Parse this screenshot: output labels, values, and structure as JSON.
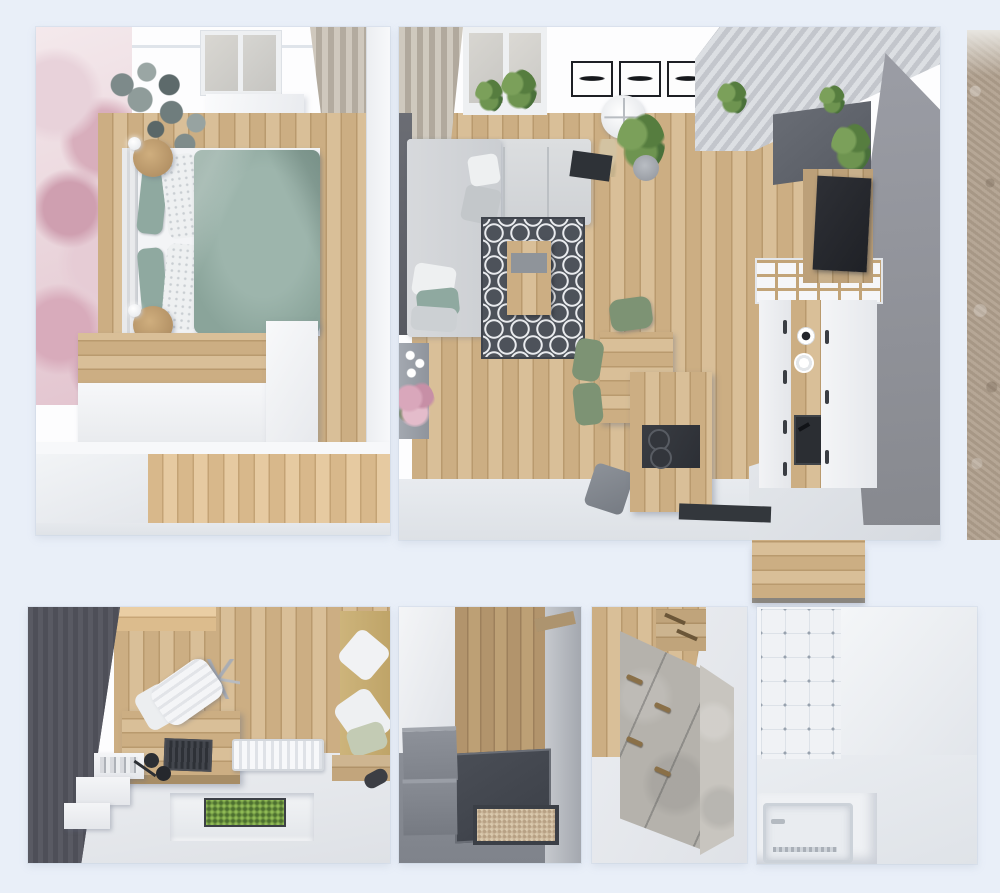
{
  "meta": {
    "description": "Top-down 3D interior render collage of a small apartment, six framed views on a pale blue background, no visible text",
    "view": "top-down orthographic render",
    "text_visible": "none"
  },
  "colors": {
    "background": "#e9eff8",
    "panel_white": "#fdfdfe",
    "wood_light": "#d9bf98",
    "wood_mid": "#ccae83",
    "wood_seam": "#b99a6e",
    "hall_wood": "#b2946c",
    "sage_green": "#8fa9a0",
    "chair_green": "#7d9374",
    "mural_pink": "#dfb9c7",
    "sofa_gray": "#d8dadd",
    "rug": "#4d525a",
    "rug_pattern": "#e9ebee",
    "gray_accent_wall": "#8e9099",
    "charcoal_wall": "#53545d",
    "concrete_front": "#b5b2ac",
    "concrete_side": "#c8c5bf",
    "gray_cabinet": "#82868e",
    "entry_dark_floor": "#43474f",
    "doormat_beige": "#cbb79b",
    "stone": "#b0a08e",
    "curtain_beige": "#c2bab0",
    "plant_green": "#5f7d4a",
    "tv_black": "#26282d",
    "daybed_tan": "#c9b177",
    "tile_white": "#f0f2f5"
  },
  "panels": [
    {
      "name": "bedroom",
      "objects": [
        "floral-wall-mural",
        "circle-mirror-wall-decor",
        "window",
        "window-sill-cabinet",
        "curtain",
        "double-bed",
        "headboard",
        "sage-duvet",
        "green-pillows",
        "patterned-pillows",
        "round-nightstand-top",
        "round-nightstand-bottom",
        "ball-lamps",
        "wood-dresser",
        "white-desk",
        "white-partition",
        "wardrobe",
        "wood-plank-floor",
        "corridor-floor"
      ]
    },
    {
      "name": "living-room-kitchen",
      "objects": [
        "beige-curtain",
        "window-with-plants",
        "three-framed-prints",
        "slatted-ceiling",
        "gray-accent-wall",
        "l-shaped-gray-sofa",
        "throw-pillows",
        "trellis-pattern-rug",
        "wood-coffee-table",
        "gray-console-with-flower-bouquet",
        "drum-floor-lamp",
        "pampas-grass",
        "potted-plant",
        "dark-doormat",
        "wood-dining-table",
        "green-dining-chairs",
        "gray-stool",
        "kitchen-island-with-cooktop",
        "open-shelf-unit",
        "white-kitchen-cabinets",
        "wood-cabinet-strip",
        "kitchen-sink-with-faucet",
        "white-plates",
        "dark-wall-cabinets",
        "wall-planters",
        "tv-on-wood-panel",
        "entry-mat",
        "wood-floor",
        "kitchen-peninsula-counter"
      ]
    },
    {
      "name": "stone-texture-strip",
      "objects": [
        "beige-stone-wall-texture"
      ]
    },
    {
      "name": "home-office",
      "objects": [
        "charcoal-plank-wall",
        "wood-floor",
        "wood-desk",
        "white-swivel-chair",
        "laptop",
        "black-desk-lamp",
        "white-wall-shelves-with-books",
        "white-radiator",
        "recessed-planter-with-greenery",
        "tan-daybed-with-pillows",
        "wood-bench",
        "dark-slipper"
      ]
    },
    {
      "name": "entry-hallway",
      "objects": [
        "white-wall",
        "wood-floor",
        "gray-wall",
        "wood-wall-shelf",
        "dark-entry-floor",
        "beige-doormat",
        "two-gray-storage-cabinets"
      ]
    },
    {
      "name": "dresser-nook",
      "objects": [
        "wood-plank-wall",
        "wood-wall-cabinet-with-handles",
        "concrete-chest-of-drawers",
        "wood-drawer-handles"
      ]
    },
    {
      "name": "bathroom",
      "objects": [
        "white-mosaic-tile-wall",
        "light-gray-wall",
        "recessed-bathtub",
        "tub-faucet",
        "drain-grate"
      ]
    }
  ]
}
